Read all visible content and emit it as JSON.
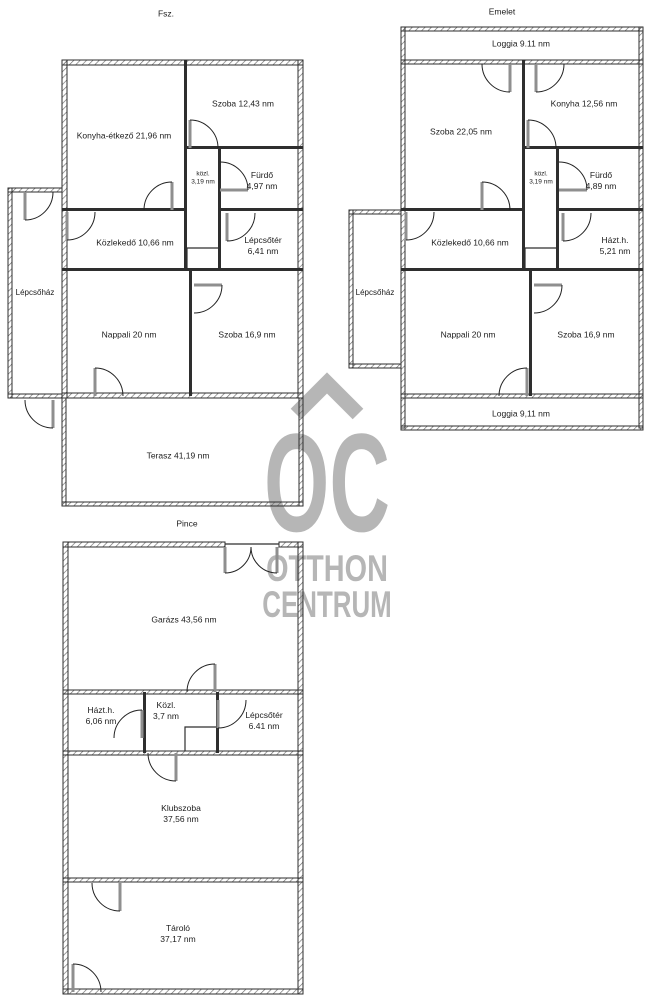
{
  "colors": {
    "background": "#ffffff",
    "wall": "#2e2e2e",
    "label": "#1c1c1c",
    "watermark": "#b6b6b6"
  },
  "watermark": {
    "logo_text": "OC",
    "line1": "OTTHON",
    "line2": "CENTRUM"
  },
  "floors": {
    "fsz": {
      "title": "Fsz.",
      "rooms": {
        "konyha_etkezo": "Konyha-étkező 21,96 nm",
        "szoba_felso": "Szoba 12,43 nm",
        "kozl_1": "közl.",
        "kozl_2": "3,19 nm",
        "furdo_1": "Fürdő",
        "furdo_2": "4,97 nm",
        "kozlekedo": "Közlekedő 10,66 nm",
        "lepcsoter_1": "Lépcsőtér",
        "lepcsoter_2": "6,41 nm",
        "lepcsohaz": "Lépcsőház",
        "nappali": "Nappali 20 nm",
        "szoba_also": "Szoba 16,9 nm",
        "terasz": "Terasz 41,19 nm"
      }
    },
    "emelet": {
      "title": "Emelet",
      "rooms": {
        "loggia_felso": "Loggia 9.11 nm",
        "szoba_felso": "Szoba 22,05 nm",
        "konyha": "Konyha 12,56 nm",
        "kozl_1": "közl.",
        "kozl_2": "3,19 nm",
        "furdo_1": "Fürdő",
        "furdo_2": "4,89 nm",
        "kozlekedo": "Közlekedő 10,66 nm",
        "hazth_1": "Házt.h.",
        "hazth_2": "5,21 nm",
        "lepcsohaz": "Lépcsőház",
        "nappali": "Nappali 20 nm",
        "szoba_also": "Szoba 16,9 nm",
        "loggia_also": "Loggia 9,11 nm"
      }
    },
    "pince": {
      "title": "Pince",
      "rooms": {
        "garazs": "Garázs 43,56 nm",
        "hazth_1": "Házt.h.",
        "hazth_2": "6,06 nm",
        "kozl_1": "Közl.",
        "kozl_2": "3,7 nm",
        "lepcsoter_1": "Lépcsőtér",
        "lepcsoter_2": "6.41 nm",
        "klubszoba_1": "Klubszoba",
        "klubszoba_2": "37,56 nm",
        "tarolo_1": "Tároló",
        "tarolo_2": "37,17 nm"
      }
    }
  }
}
